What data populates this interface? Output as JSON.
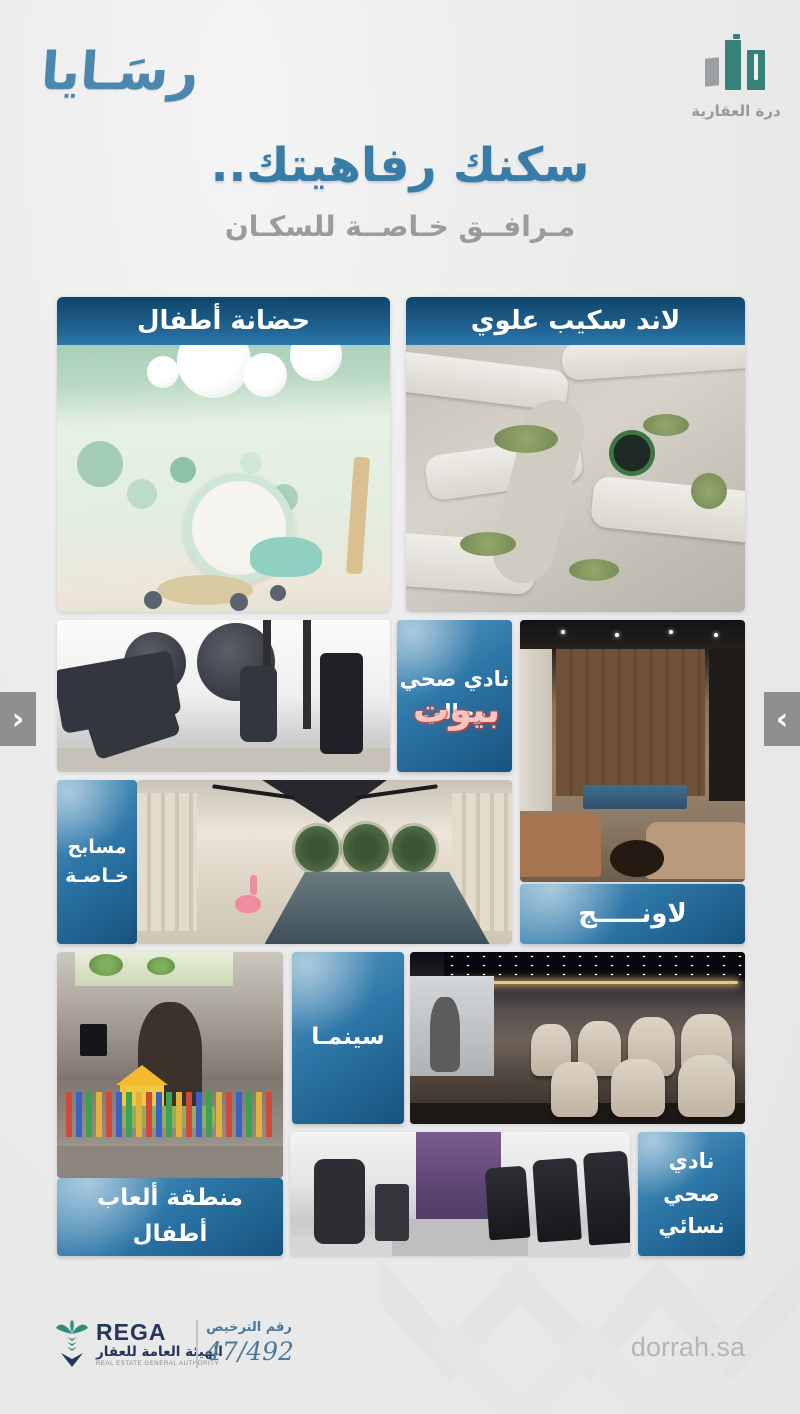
{
  "brand": {
    "rasaya_logo": "رسَـايا",
    "dorrah_logo_name": "درة العقارية"
  },
  "header": {
    "title": "سكنك رفاهيتك..",
    "subtitle": "مـرافــق خـاصــة للسكـان"
  },
  "labels": {
    "nursery": "حضانة أطفال",
    "upper_landscape": "لاند سكيب علوي",
    "mens_health_club": "نادي صحي رجالي",
    "lounge": "لاونـــــج",
    "private_pools": "مسابح خـاصـة",
    "cinema": "سينمـا",
    "kids_play_area": "منطقة ألعاب أطفال",
    "womens_health_club": "نادي صحي نسائي"
  },
  "carousel": {
    "prev_icon": "‹",
    "next_icon": "›"
  },
  "watermark_text": "بيوت",
  "footer": {
    "rega_en": "REGA",
    "rega_ar": "الهيئة العامة للعقار",
    "rega_sub_en": "REAL ESTATE GENERAL AUTHORITY",
    "license_label": "رقم الترخيص",
    "license_value": "47/492",
    "website": "dorrah.sa"
  },
  "colors": {
    "band_blue_top": "#0f456c",
    "band_blue_bottom": "#2b77aa",
    "label_box_light": "#5f9cc1",
    "label_box_dark": "#17537f",
    "title_blue": "#3a7ca8",
    "subtitle_gray": "#9b9b9b",
    "dorrah_teal": "#37817a",
    "rega_navy": "#25365a",
    "license_blue": "#4a7a9b",
    "watermark_red": "#d84b3e",
    "page_bg": "#ebebeb"
  }
}
